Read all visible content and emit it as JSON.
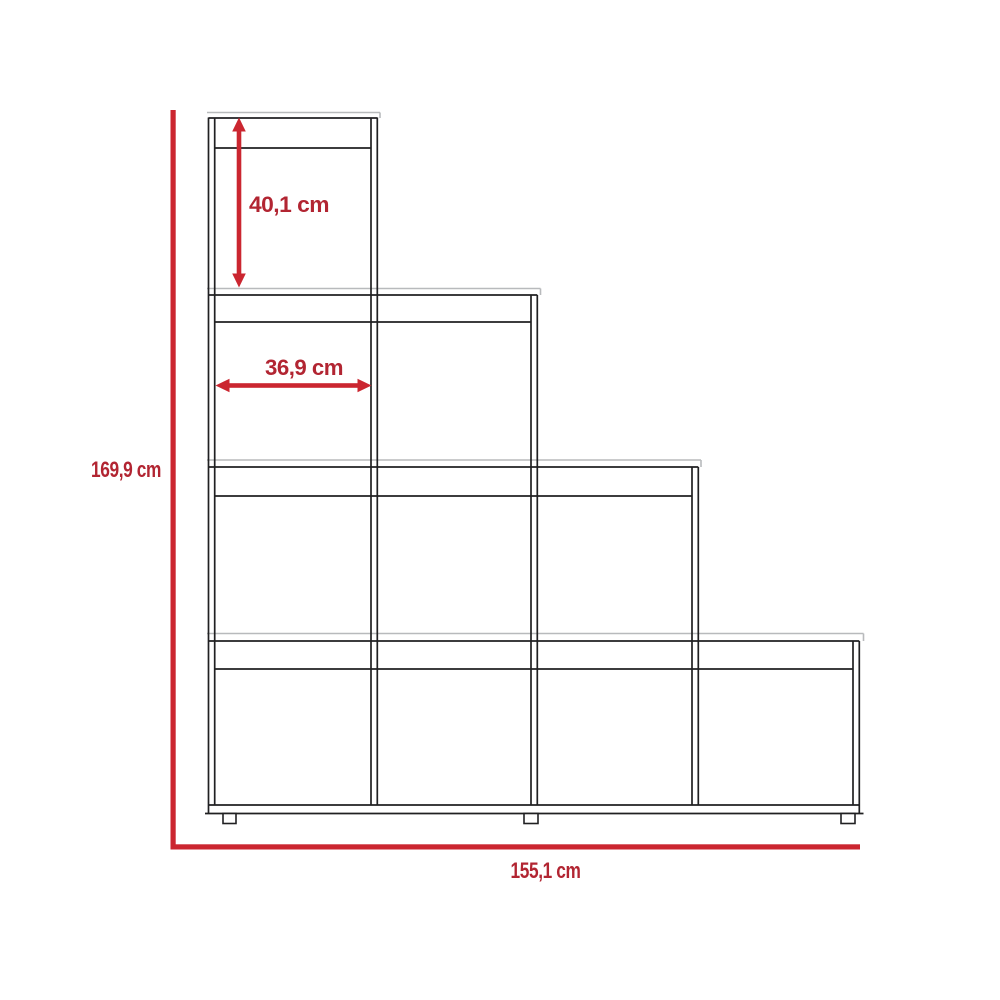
{
  "diagram": {
    "unit": "cm",
    "dimensions": {
      "total_height": {
        "label": "169,9 cm",
        "value": 169.9
      },
      "total_width": {
        "label": "155,1 cm",
        "value": 155.1
      },
      "top_cube_height": {
        "label": "40,1 cm",
        "value": 40.1
      },
      "cube_inner_width": {
        "label": "36,9 cm",
        "value": 36.9
      }
    },
    "colors": {
      "dimension_line_red": "#cb2630",
      "dimension_text_red": "#b22532",
      "furniture_line_dark": "#202022",
      "furniture_line_grey": "#b8babc",
      "background": "#ffffff"
    }
  }
}
